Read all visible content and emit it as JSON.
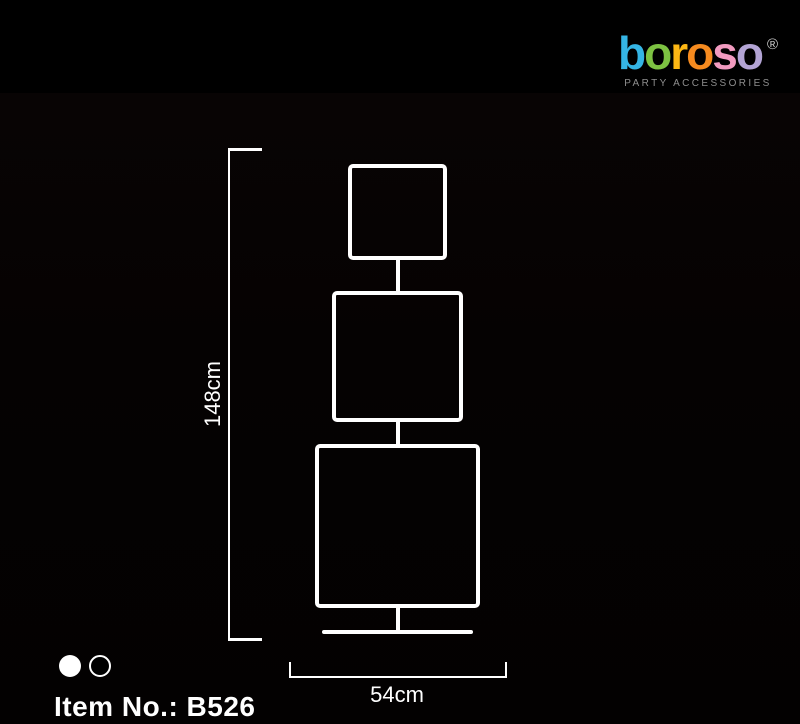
{
  "brand": {
    "letters": [
      {
        "char": "b",
        "color": "#35b5e5"
      },
      {
        "char": "o",
        "color": "#7dc242"
      },
      {
        "char": "r",
        "color": "#fdb714"
      },
      {
        "char": "o",
        "color": "#f68b1f"
      },
      {
        "char": "s",
        "color": "#f29bc0"
      },
      {
        "char": "o",
        "color": "#b3a4d4"
      }
    ],
    "registered_mark": "®",
    "tagline": "PARTY ACCESSORIES"
  },
  "diagram": {
    "height_label": "148cm",
    "width_label": "54cm",
    "stroke_color": "#ffffff",
    "shapes": [
      "top-square",
      "middle-square",
      "bottom-square",
      "base-bar"
    ]
  },
  "footer": {
    "item_number_label": "Item No.: B526",
    "color_options": [
      {
        "name": "white"
      },
      {
        "name": "black"
      }
    ]
  }
}
